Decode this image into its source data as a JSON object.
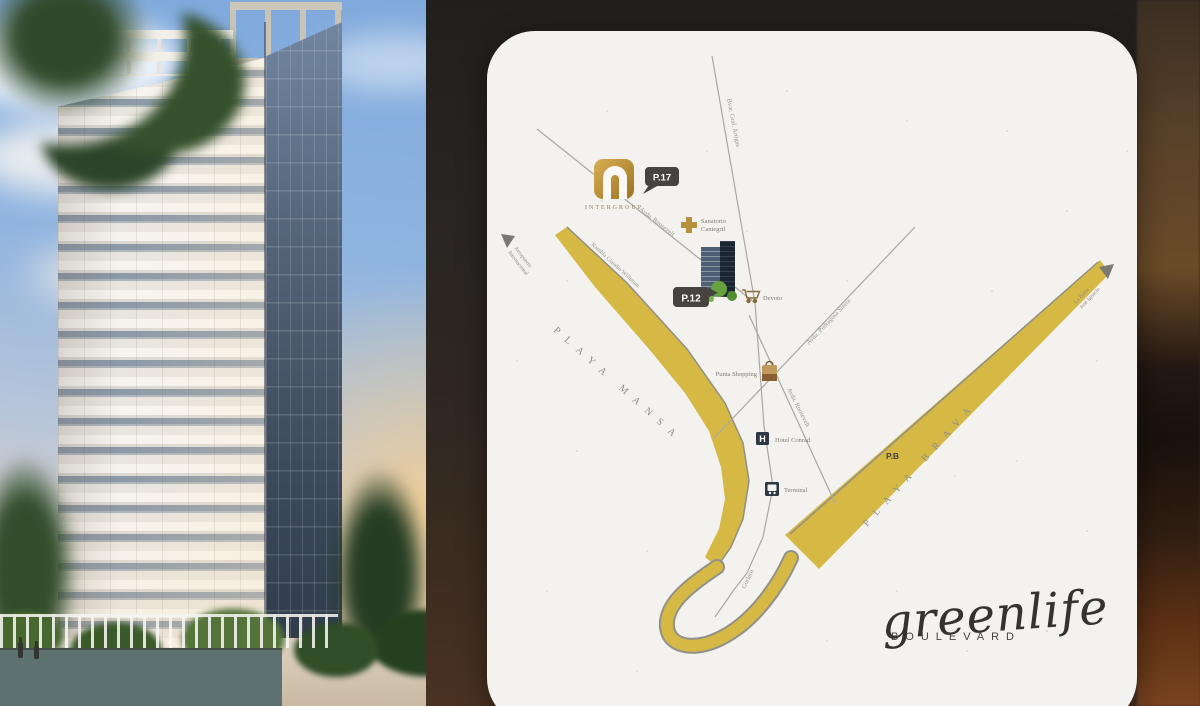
{
  "brand": {
    "script": "greenlife",
    "sub": "BOULEVARD"
  },
  "map": {
    "developer_logo": {
      "name": "INTERGROUP"
    },
    "markers": {
      "p17": "P.17",
      "p12": "P.12",
      "pb": "P.B"
    },
    "places": {
      "sanatorio_line1": "Sanatorio",
      "sanatorio_line2": "Cantegril",
      "devoto": "Devoto",
      "shopping": "Punta Shopping",
      "hotel": "Hotel Conrad",
      "terminal": "Terminal"
    },
    "streets": {
      "artigas": "Bvar. Gral. Artigas",
      "roosevelt_upper": "Avda. Roosevelt",
      "roosevelt_lower": "Avda. Roosevelt",
      "pedragosa": "Avda. Pedragosa Sierra",
      "rambla_williman": "Rambla Claudio Williman",
      "gorlero": "Gorlero"
    },
    "areas": {
      "mansa": "PLAYA MANSA",
      "brava": "PLAYA BRAVA"
    },
    "directions": {
      "west_line1": "Aeropuerto",
      "west_line2": "Internacional",
      "east_line1": "La Barra",
      "east_line2": "José Ignacio"
    },
    "hotel_icon_letter": "H"
  },
  "colors": {
    "beach_gold": "#d6b944",
    "logo_gold": "#c9a04a",
    "badge_dark": "#474440",
    "card_bg": "#f4f2ee"
  }
}
